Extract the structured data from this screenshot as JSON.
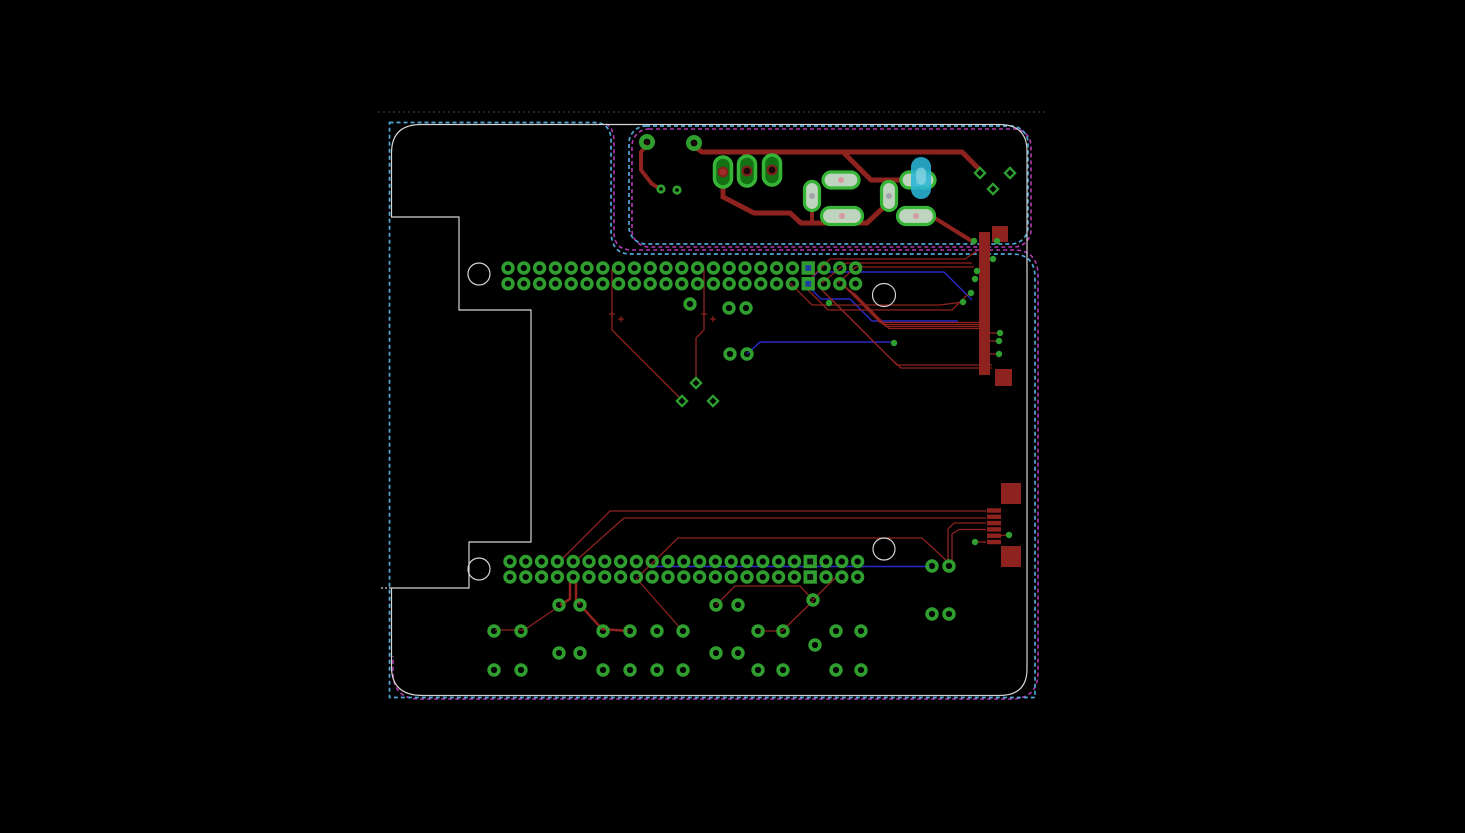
{
  "app": {
    "title": "PCB Layout Editor Canvas"
  },
  "colors": {
    "bg": "#000000",
    "trace_red": "#8e221e",
    "trace_blue": "#2a2ac8",
    "pad_green": "#2f9e2f",
    "pad_green_bright": "#35b435",
    "smd_fill": "#cfe6cf",
    "tht_fill": "#137013",
    "dot_pink": "#d98f9f",
    "dot_gray": "#9a9aa8",
    "dash_cyan": "#4fa8d8",
    "dash_magenta": "#b23ab2",
    "dash_gray": "#3a3a3a",
    "silk_white": "#d4d4d4",
    "hole_dark": "#1c0808",
    "hole_red": "#a42c26",
    "sq_inner_blue": "#1e3f9e",
    "sq_inner_dark": "#0d0d0d",
    "cyan_comp": "#2ab5d6",
    "cyan_comp_light": "#8fd8e2"
  },
  "pcb": {
    "viewport": {
      "w": 1465,
      "h": 833
    },
    "outlines": {
      "gray_dashed": {
        "y": 112,
        "x1": 378,
        "x2": 1045
      },
      "cyan_main_path": "M389.5,122.5 H594 Q611,122.5 611,141 V230 Q611,254 630,254 H1012 Q1035,254 1035,278 V697.5 H389.5 Z",
      "cyan_section": {
        "x": 629,
        "y": 126,
        "w": 399,
        "h": 118,
        "r": 17
      },
      "magenta_section": {
        "x": 632,
        "y": 129,
        "w": 399,
        "h": 118,
        "r": 17
      },
      "magenta_main_path": "M606,124 Q614,128 614,142 V232 Q614,250 632,250 H1014 Q1038,250 1038,276 V672 Q1038,699 1011,699 H420 Q393,699 393,672 V656",
      "white_path": "M391.5,153 Q391.5,124.5 421,124.5 H999 Q1027,124.5 1027,151 V669 Q1027,695.5 999,695.5 H423 Q391.5,695.5 391.5,667 V588 H469 V542 H531 V310 H459 V217 H391.5 Z",
      "white_tick": {
        "x1": 381,
        "y1": 588,
        "x2": 391,
        "y2": 588
      }
    },
    "mounting_holes": [
      [
        479,
        274,
        11
      ],
      [
        884,
        295,
        11.5
      ],
      [
        479,
        569,
        11
      ],
      [
        884,
        549,
        11
      ]
    ],
    "headers": {
      "top": {
        "x0": 508,
        "pitch": 15.8,
        "count": 23,
        "rows": [
          268,
          283.7
        ],
        "square_index": 19,
        "square_inner": "blue"
      },
      "bottom": {
        "x0": 510,
        "pitch": 15.8,
        "count": 23,
        "rows": [
          561.5,
          577
        ],
        "square_index": 19,
        "square_inner": "dark"
      }
    },
    "scatter_pads": [
      [
        690,
        304
      ],
      [
        729,
        308
      ],
      [
        746,
        308
      ],
      [
        730,
        354
      ],
      [
        747,
        354
      ],
      [
        559,
        605
      ],
      [
        580,
        605
      ],
      [
        716,
        605
      ],
      [
        738,
        605
      ],
      [
        813,
        600
      ],
      [
        494,
        631
      ],
      [
        521,
        631
      ],
      [
        603,
        631
      ],
      [
        630,
        631
      ],
      [
        657,
        631
      ],
      [
        683,
        631
      ],
      [
        758,
        631
      ],
      [
        783,
        631
      ],
      [
        836,
        631
      ],
      [
        861,
        631
      ],
      [
        559,
        653
      ],
      [
        580,
        653
      ],
      [
        716,
        653
      ],
      [
        738,
        653
      ],
      [
        815,
        645
      ],
      [
        494,
        670
      ],
      [
        521,
        670
      ],
      [
        603,
        670
      ],
      [
        630,
        670
      ],
      [
        657,
        670
      ],
      [
        683,
        670
      ],
      [
        758,
        670
      ],
      [
        783,
        670
      ],
      [
        836,
        670
      ],
      [
        861,
        670
      ],
      [
        932,
        566
      ],
      [
        949,
        566
      ],
      [
        932,
        614
      ],
      [
        949,
        614
      ]
    ],
    "small_pads": [
      [
        661,
        189
      ],
      [
        677,
        190
      ]
    ],
    "tht_circle_pads": [
      [
        647,
        142
      ],
      [
        694,
        143
      ]
    ],
    "tht_oval_pads": [
      {
        "cx": 723,
        "cy": 172,
        "w": 17,
        "h": 30,
        "hole": "red"
      },
      {
        "cx": 747,
        "cy": 171,
        "w": 17,
        "h": 30,
        "hole": "dark"
      },
      {
        "cx": 772,
        "cy": 170,
        "w": 17,
        "h": 30,
        "hole": "dark"
      }
    ],
    "smd_pads": [
      {
        "cx": 812,
        "cy": 196,
        "w": 15,
        "h": 29,
        "dot": "gray"
      },
      {
        "cx": 841,
        "cy": 180,
        "w": 36,
        "h": 16,
        "dot": "pink"
      },
      {
        "cx": 842,
        "cy": 216,
        "w": 41,
        "h": 17,
        "dot": "pink"
      },
      {
        "cx": 889,
        "cy": 196,
        "w": 15,
        "h": 29,
        "dot": "gray"
      },
      {
        "cx": 918,
        "cy": 180,
        "w": 34,
        "h": 16,
        "dot": "gray"
      },
      {
        "cx": 916,
        "cy": 216,
        "w": 37,
        "h": 17,
        "dot": "pink"
      }
    ],
    "cyan_component": {
      "cx": 921,
      "cy": 178,
      "w": 20,
      "h": 42
    },
    "diamonds": [
      [
        696,
        383
      ],
      [
        682,
        401
      ],
      [
        713,
        401
      ],
      [
        980,
        173
      ],
      [
        1010,
        173
      ],
      [
        993,
        189
      ]
    ],
    "vias": [
      [
        974,
        241
      ],
      [
        997,
        241
      ],
      [
        993,
        259
      ],
      [
        977,
        271
      ],
      [
        975,
        279
      ],
      [
        971,
        293
      ],
      [
        963,
        302
      ],
      [
        1000,
        333
      ],
      [
        999,
        341
      ],
      [
        999,
        354
      ],
      [
        894,
        343
      ],
      [
        829,
        303
      ],
      [
        975,
        542
      ],
      [
        1009,
        535
      ]
    ],
    "bus_bar": {
      "x": 979,
      "y": 232,
      "w": 11,
      "h": 143
    },
    "red_squares": [
      [
        992,
        226,
        16,
        16
      ],
      [
        995,
        369,
        17,
        17
      ],
      [
        1001,
        483,
        20,
        21
      ],
      [
        1001,
        546,
        20,
        21
      ]
    ],
    "usb_pins": {
      "x": 987,
      "w": 14,
      "h": 4.5,
      "ys": [
        510.5,
        516.8,
        523.1,
        529.4,
        535.7,
        542
      ]
    },
    "traces": {
      "thick": [
        {
          "pts": [
            [
              695,
              147
            ],
            [
              702,
              152
            ],
            [
              962,
              152
            ],
            [
              979,
              169
            ]
          ],
          "w": 5
        },
        {
          "pts": [
            [
              745,
              152
            ],
            [
              745,
              163
            ]
          ],
          "w": 5
        },
        {
          "pts": [
            [
              723,
              183
            ],
            [
              723,
              197
            ],
            [
              754,
              213
            ],
            [
              790,
              213
            ],
            [
              801,
              223
            ],
            [
              867,
              223
            ],
            [
              886,
              205
            ]
          ],
          "w": 5
        },
        {
          "pts": [
            [
              812,
              207
            ],
            [
              812,
              221
            ]
          ],
          "w": 4
        },
        {
          "pts": [
            [
              843,
              152
            ],
            [
              871,
              180
            ],
            [
              902,
              180
            ]
          ],
          "w": 5
        },
        {
          "pts": [
            [
              933,
              217
            ],
            [
              975,
              243
            ]
          ],
          "w": 4
        },
        {
          "pts": [
            [
              647,
              145
            ],
            [
              641,
              152
            ],
            [
              641,
              170
            ],
            [
              652,
              184
            ],
            [
              659,
              188
            ]
          ],
          "w": 4
        }
      ],
      "medium": [
        {
          "pts": [
            [
              570,
              579
            ],
            [
              570,
              599
            ],
            [
              560,
              605
            ]
          ],
          "w": 2.5
        },
        {
          "pts": [
            [
              576,
              579
            ],
            [
              576,
              600
            ],
            [
              580,
              604
            ]
          ],
          "w": 2.5
        },
        {
          "pts": [
            [
              582,
              607
            ],
            [
              602,
              629
            ],
            [
              628,
              631
            ]
          ],
          "w": 2.5
        }
      ],
      "thin": [
        {
          "pts": [
            [
              806,
              283
            ],
            [
              830,
              259
            ],
            [
              965,
              259
            ],
            [
              977,
              251
            ]
          ]
        },
        {
          "pts": [
            [
              822,
              283
            ],
            [
              846,
              263
            ],
            [
              972,
              263
            ]
          ]
        },
        {
          "pts": [
            [
              838,
              283
            ],
            [
              856,
              267
            ],
            [
              974,
              267
            ]
          ]
        },
        {
          "pts": [
            [
              790,
              283
            ],
            [
              812,
              305
            ],
            [
              940,
              305
            ],
            [
              963,
              302
            ]
          ]
        },
        {
          "pts": [
            [
              806,
              288
            ],
            [
              828,
              310
            ],
            [
              952,
              310
            ],
            [
              966,
              296
            ],
            [
              971,
              293
            ]
          ]
        },
        {
          "pts": [
            [
              842,
              284
            ],
            [
              880,
              322.5
            ],
            [
              979,
              322.5
            ]
          ]
        },
        {
          "pts": [
            [
              846,
              287
            ],
            [
              883,
              324.5
            ],
            [
              979,
              324.5
            ]
          ]
        },
        {
          "pts": [
            [
              850,
              290
            ],
            [
              886,
              326.5
            ],
            [
              979,
              326.5
            ]
          ]
        },
        {
          "pts": [
            [
              854,
              293
            ],
            [
              889,
              328.5
            ],
            [
              979,
              328.5
            ]
          ]
        },
        {
          "pts": [
            [
              820,
              288
            ],
            [
              852,
              320
            ],
            [
              893,
              361
            ],
            [
              897,
              365
            ],
            [
              992,
              365
            ]
          ]
        },
        {
          "pts": [
            [
              824,
              292
            ],
            [
              856,
              324
            ],
            [
              889,
              357
            ],
            [
              901,
              368
            ],
            [
              992,
              368
            ]
          ]
        },
        {
          "pts": [
            [
              612,
              269
            ],
            [
              612,
              330
            ],
            [
              680,
              398
            ]
          ]
        },
        {
          "pts": [
            [
              704,
              269
            ],
            [
              704,
              330
            ],
            [
              696,
              338
            ],
            [
              696,
              380
            ]
          ]
        },
        {
          "pts": [
            [
              563,
              558
            ],
            [
              610,
              511
            ],
            [
              986,
              511
            ]
          ]
        },
        {
          "pts": [
            [
              579,
              558
            ],
            [
              624,
              518
            ],
            [
              986,
              518
            ]
          ]
        },
        {
          "pts": [
            [
              638,
              577
            ],
            [
              678,
              538
            ],
            [
              922,
              538
            ],
            [
              949,
              563
            ]
          ]
        },
        {
          "pts": [
            [
              948,
              560
            ],
            [
              948,
              529
            ],
            [
              954,
              523
            ],
            [
              986,
              523
            ]
          ]
        },
        {
          "pts": [
            [
              952,
              560
            ],
            [
              952,
              534
            ],
            [
              959,
              529.5
            ],
            [
              986,
              529.5
            ]
          ]
        },
        {
          "pts": [
            [
              975,
              542
            ],
            [
              986,
              542
            ]
          ]
        },
        {
          "pts": [
            [
              1001,
              535.5
            ],
            [
              1009,
              535
            ]
          ]
        },
        {
          "pts": [
            [
              636,
              578
            ],
            [
              681,
              629
            ]
          ]
        },
        {
          "pts": [
            [
              558,
              607
            ],
            [
              524,
              630
            ],
            [
              495,
              630
            ]
          ]
        },
        {
          "pts": [
            [
              716,
              605
            ],
            [
              735,
              586
            ],
            [
              800,
              586
            ],
            [
              812,
              599
            ]
          ]
        },
        {
          "pts": [
            [
              760,
              631
            ],
            [
              783,
              631
            ]
          ]
        },
        {
          "pts": [
            [
              783,
              630
            ],
            [
              813,
              601
            ]
          ]
        },
        {
          "pts": [
            [
              813,
              600
            ],
            [
              835,
              578
            ]
          ]
        },
        {
          "pts": [
            [
              990,
              333
            ],
            [
              1000,
              333
            ]
          ]
        },
        {
          "pts": [
            [
              990,
              341
            ],
            [
              999,
              341
            ]
          ]
        },
        {
          "pts": [
            [
              990,
              354
            ],
            [
              999,
              354
            ]
          ]
        }
      ],
      "blue": [
        {
          "pts": [
            [
              806,
              284
            ],
            [
              821,
              299
            ],
            [
              850,
              299
            ],
            [
              872,
              321
            ],
            [
              958,
              321
            ]
          ]
        },
        {
          "pts": [
            [
              806,
              284
            ],
            [
              818,
              272
            ],
            [
              944,
              272
            ],
            [
              972,
              300
            ]
          ]
        },
        {
          "pts": [
            [
              747,
              354
            ],
            [
              760,
              342
            ],
            [
              890,
              342
            ],
            [
              894,
              343
            ]
          ]
        },
        {
          "pts": [
            [
              653,
              566.5
            ],
            [
              930,
              566.5
            ]
          ]
        }
      ]
    },
    "origin_crosses": [
      [
        612,
        314
      ],
      [
        621,
        319
      ],
      [
        704,
        314
      ],
      [
        713,
        319
      ]
    ]
  }
}
